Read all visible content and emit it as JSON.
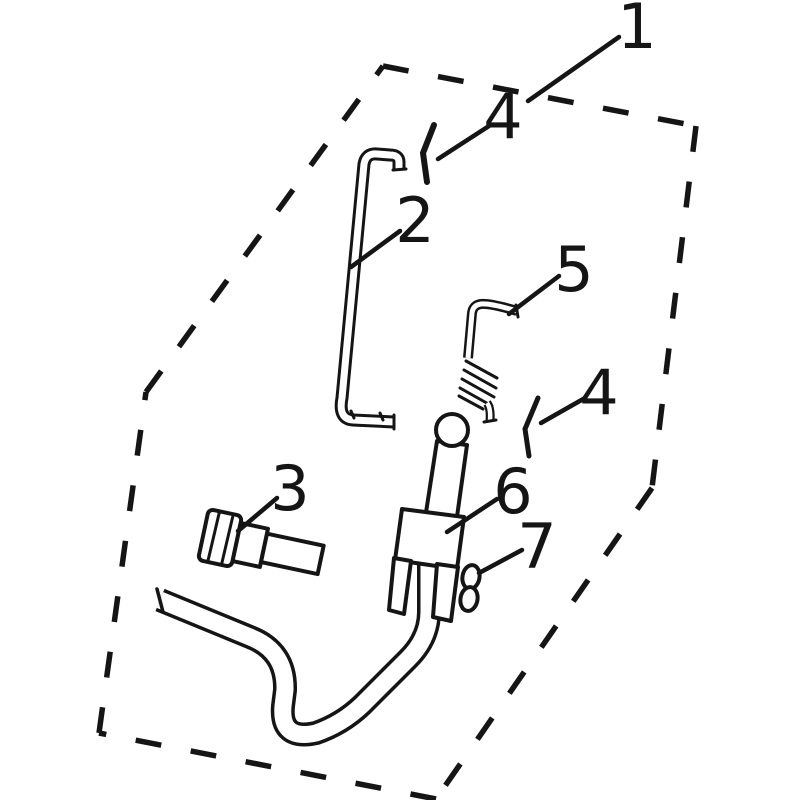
{
  "diagram": {
    "title": "exploded-parts-diagram",
    "background_color": "#ffffff",
    "line_color": "#151515",
    "boundary_part_number": "1",
    "callouts": [
      {
        "number": "1",
        "part": "dashed-panel-outline"
      },
      {
        "number": "4",
        "part": "cotter-pin-upper"
      },
      {
        "number": "2",
        "part": "bent-support-rod"
      },
      {
        "number": "5",
        "part": "tension-spring-hook"
      },
      {
        "number": "4",
        "part": "cotter-pin-lower"
      },
      {
        "number": "3",
        "part": "hex-bolt"
      },
      {
        "number": "6",
        "part": "clamp-sleeve-tube"
      },
      {
        "number": "7",
        "part": "retainer-clip"
      }
    ]
  }
}
